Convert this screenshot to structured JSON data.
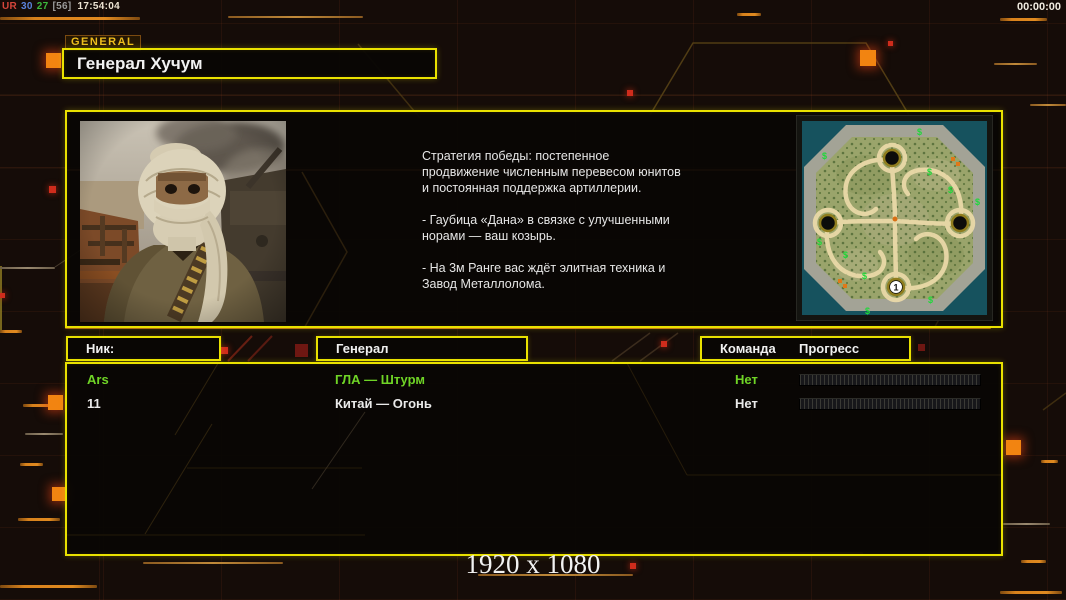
{
  "hud": {
    "perf": {
      "label": "UR",
      "fps": "30",
      "frametime": "27",
      "bracket": "[56]",
      "clock": "17:54:04"
    },
    "match_timer": "00:00:00"
  },
  "general_screen": {
    "tab_label": "GENERAL",
    "general_name": "Генерал Хучум",
    "briefing_p1": "Стратегия победы: постепенное продвижение численным перевесом юнитов и постоянная поддержка артиллерии.",
    "briefing_p2": "- Гаубица «Дана» в связке с улучшенными норами — ваш козырь.",
    "briefing_p3": "- На 3м Ранге вас ждёт элитная техника и Завод Металлолома.",
    "minimap": {
      "start_label": "1",
      "supply_symbol": "$"
    }
  },
  "roster": {
    "headers": {
      "nick": "Ник:",
      "general": "Генерал",
      "team": "Команда",
      "progress": "Прогресс"
    },
    "rows": [
      {
        "nick": "Ars",
        "general": "ГЛА — Штурм",
        "team": "Нет",
        "progress_percent": 0,
        "text_color": "#6fd426"
      },
      {
        "nick": "11",
        "general": "Китай — Огонь",
        "team": "Нет",
        "progress_percent": 0,
        "text_color": "#eaeaea"
      }
    ]
  },
  "footer": {
    "resolution": "1920 x 1080"
  },
  "theme": {
    "accent_yellow": "#e9e100",
    "accent_orange": "#cc7d18",
    "background": "#150c08",
    "green_text": "#6fd426"
  }
}
